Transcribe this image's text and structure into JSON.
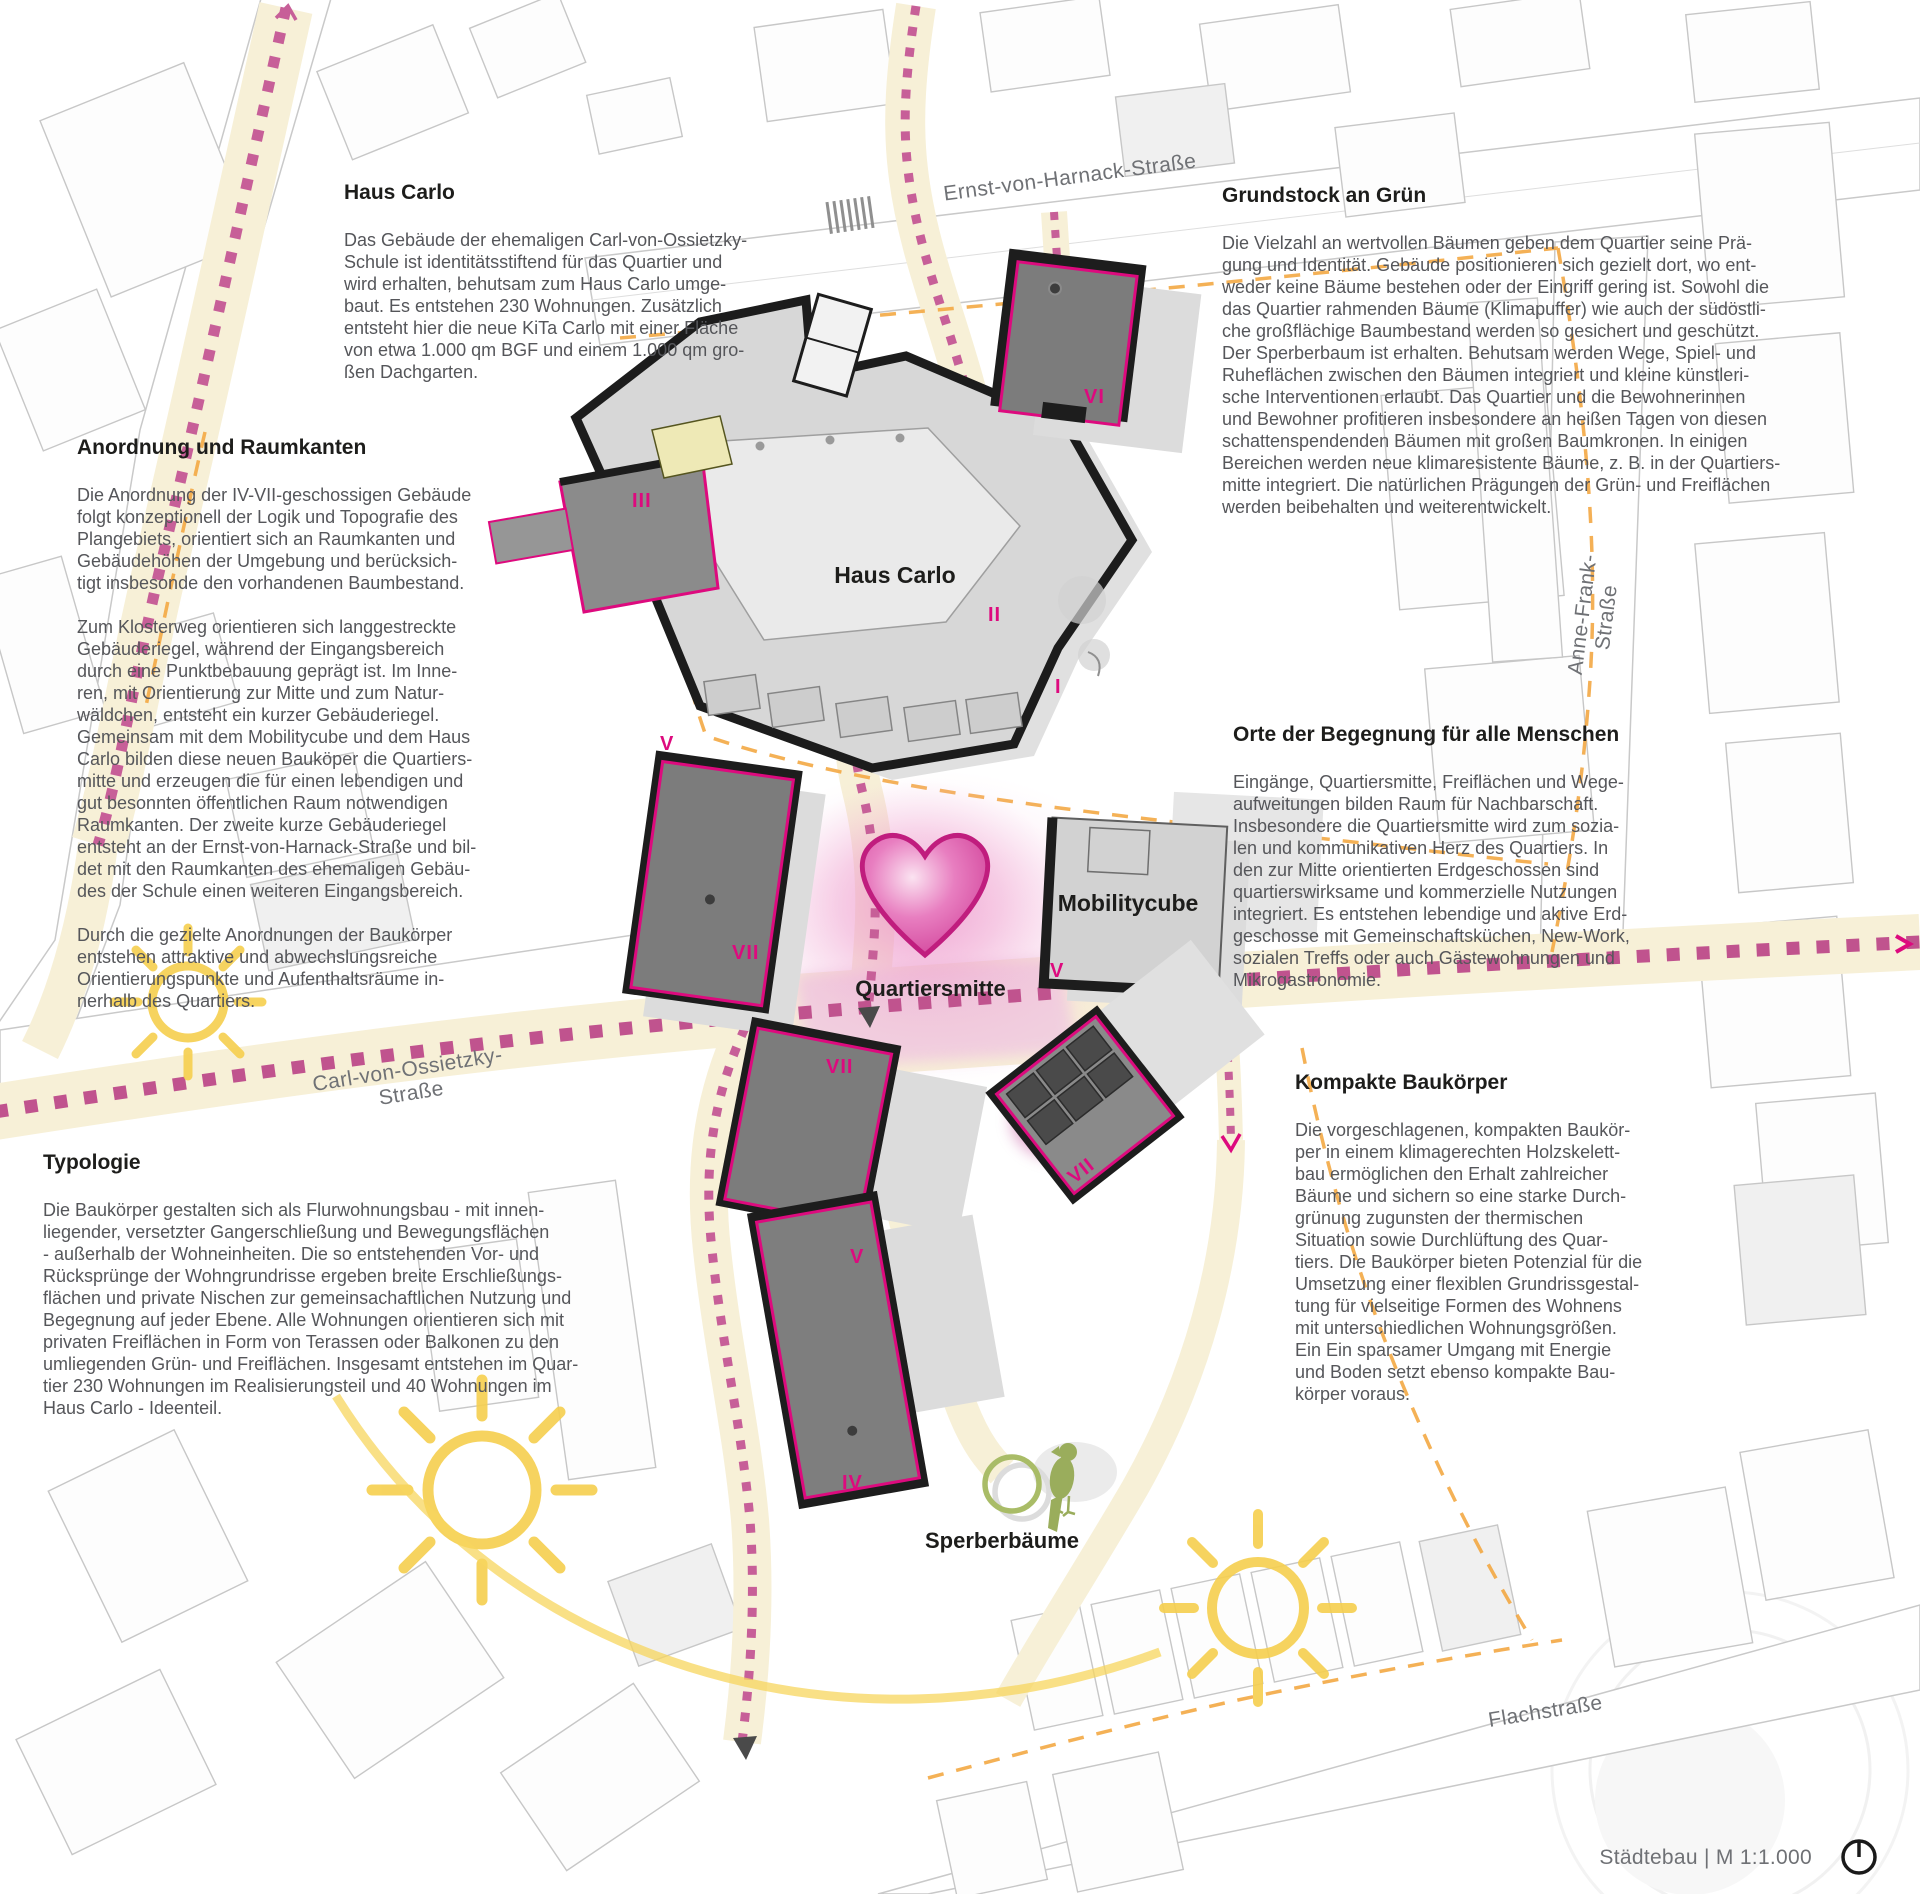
{
  "annotations": {
    "haus_carlo": {
      "title": "Haus Carlo",
      "body": "Das Gebäude der ehemaligen Carl-von-Ossietzky-\nSchule ist identitätsstiftend für das Quartier und\nwird erhalten, behutsam zum Haus Carlo umge-\nbaut. Es entstehen 230 Wohnungen. Zusätzlich\nentsteht hier die neue KiTa Carlo mit einer Fläche\nvon etwa 1.000 qm BGF und einem 1.000 qm gro-\nßen Dachgarten."
    },
    "anordnung": {
      "title": "Anordnung und Raumkanten",
      "body": "Die Anordnung der IV-VII-geschossigen Gebäude\nfolgt konzeptionell der Logik und Topografie des\nPlangebiets, orientiert sich an Raumkanten und\nGebäudehöhen der Umgebung und berücksich-\ntigt insbesonde den vorhandenen Baumbestand.\n\nZum Klosterweg orientieren sich langgestreckte\nGebäuderiegel, während der Eingangsbereich\ndurch eine Punktbebauung geprägt ist. Im Inne-\nren, mit Orientierung zur Mitte und zum Natur-\nwäldchen, entsteht ein kurzer Gebäuderiegel.\nGemeinsam mit dem Mobilitycube und dem Haus\nCarlo bilden diese neuen Bauköper die Quartiers-\nmitte und erzeugen die für einen lebendigen und\ngut besonnten öffentlichen Raum notwendigen\nRaumkanten. Der zweite kurze Gebäuderiegel\nentsteht an der Ernst-von-Harnack-Straße und bil-\ndet mit den Raumkanten des ehemaligen Gebäu-\ndes der Schule einen weiteren Eingangsbereich.\n\nDurch die gezielte Anordnungen der Baukörper\nentstehen attraktive und abwechslungsreiche\nOrientierungspunkte und Aufenthaltsräume in-\nnerhalb des Quartiers."
    },
    "typologie": {
      "title": "Typologie",
      "body": "Die Baukörper gestalten sich als Flurwohnungsbau - mit innen-\nliegender, versetzter Gangerschließung und Bewegungsflächen\n- außerhalb der Wohneinheiten. Die so entstehenden Vor- und\nRücksprünge der Wohngrundrisse ergeben breite Erschließungs-\nflächen und private Nischen zur gemeinsachaftlichen Nutzung und\nBegegnung auf jeder Ebene. Alle Wohnungen orientieren sich mit\nprivaten Freiflächen in Form von Terassen oder Balkonen zu den\numliegenden Grün- und Freiflächen. Insgesamt entstehen im Quar-\ntier 230 Wohnungen im Realisierungsteil und 40 Wohnungen im\nHaus Carlo - Ideenteil."
    },
    "grundstock": {
      "title": "Grundstock an Grün",
      "body": "Die Vielzahl an wertvollen Bäumen geben dem Quartier seine Prä-\ngung und Identität. Gebäude positionieren sich gezielt dort, wo ent-\nweder keine Bäume bestehen oder der Eingriff gering ist. Sowohl die\ndas Quartier rahmenden Bäume (Klimapuffer) wie auch der südöstli-\nche großflächige Baumbestand werden so gesichert und geschützt.\nDer Sperberbaum ist erhalten. Behutsam werden Wege, Spiel- und\nRuheflächen zwischen den Bäumen integriert und kleine künstleri-\nsche Interventionen erlaubt. Das Quartier und die Bewohnerinnen\nund Bewohner profitieren insbesondere an heißen Tagen von diesen\nschattenspendenden Bäumen mit großen Baumkronen. In einigen\nBereichen werden neue klimaresistente Bäume, z. B. in der Quartiers-\nmitte integriert. Die natürlichen Prägungen der Grün- und Freiflächen\nwerden beibehalten und weiterentwickelt."
    },
    "orte": {
      "title": "Orte der Begegnung für alle Menschen",
      "body": "Eingänge, Quartiersmitte, Freiflächen und Wege-\naufweitungen bilden Raum für Nachbarschaft.\nInsbesondere die Quartiersmitte wird zum sozia-\nlen und kommunikativen Herz des Quartiers. In\nden zur Mitte orientierten Erdgeschossen sind\nquartierswirksame und kommerzielle Nutzungen\nintegriert. Es entstehen lebendige und aktive Erd-\ngeschosse mit Gemeinschaftsküchen, New-Work,\nsozialen Treffs oder auch Gästewohnungen und\nMikrogastronomie."
    },
    "kompakte": {
      "title": "Kompakte Baukörper",
      "body": "Die vorgeschlagenen, kompakten Baukör-\nper in einem klimagerechten Holzskelett-\nbau ermöglichen den Erhalt zahlreicher\nBäume und sichern so eine starke Durch-\ngrünung zugunsten der thermischen\nSituation sowie Durchlüftung des Quar-\ntiers. Die Baukörper bieten Potenzial für die\nUmsetzung einer flexiblen Grundrissgestal-\ntung für vielseitige Formen des Wohnens\nmit unterschiedlichen Wohnungsgrößen.\nEin Ein sparsamer Umgang mit Energie\nund Boden setzt ebenso kompakte Bau-\nkörper voraus."
    }
  },
  "map": {
    "labels": {
      "haus_carlo": "Haus Carlo",
      "mobilitycube": "Mobilitycube",
      "quartiersmitte": "Quartiersmitte",
      "sperberbaeume": "Sperberbäume"
    },
    "streets": {
      "ernst_von_harnack": "Ernst-von-Harnack-Straße",
      "anne_frank": "Anne-Frank-Straße",
      "carl_von_ossietzky": "Carl-von-Ossietzky-Straße",
      "flachstrasse": "Flachstraße"
    },
    "numerals": [
      {
        "text": "VI"
      },
      {
        "text": "III"
      },
      {
        "text": "II"
      },
      {
        "text": "I"
      },
      {
        "text": "V"
      },
      {
        "text": "VII"
      },
      {
        "text": "VII"
      },
      {
        "text": "VII"
      },
      {
        "text": "V"
      },
      {
        "text": "V"
      },
      {
        "text": "IV"
      }
    ],
    "icons": {
      "heart": "heart-icon",
      "sun": "sun-icon",
      "bird": "sparrowhawk-icon",
      "tree_circle": "tree-circle-icon",
      "north_arrow": "north-arrow-icon"
    },
    "colors": {
      "accent_magenta": "#dd0a7e",
      "path_dot_pink": "#c75f98",
      "path_cream": "#f7f0d7",
      "orange_dash": "#f3a844",
      "sun_yellow": "#f6cf4e",
      "green_bird": "#9aad5c",
      "building_dark": "#7c7c7c",
      "building_light": "#d6d6d6",
      "heart_pink": "#d456a2"
    }
  },
  "footer": {
    "scale_label": "Städtebau | M 1:1.000"
  }
}
